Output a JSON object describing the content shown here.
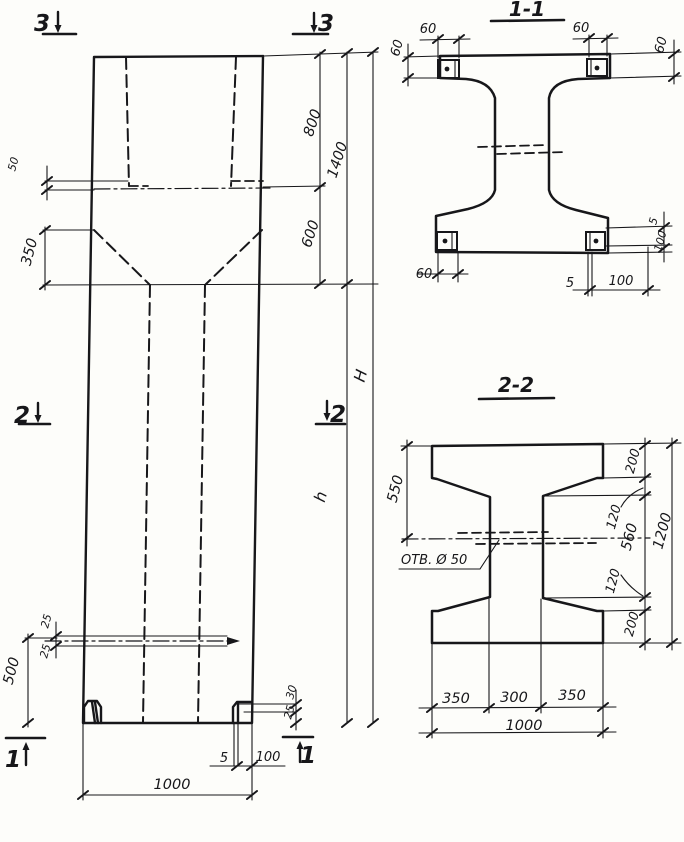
{
  "drawing": {
    "kind": "precast concrete column working drawing",
    "colors": {
      "ink": "#17171a",
      "paper": "#fdfdfa"
    }
  },
  "elevation": {
    "section_markers": {
      "top_left": "3",
      "top_right": "3",
      "mid_left": "2",
      "mid_right": "2",
      "bottom_left": "1",
      "bottom_right": "1"
    },
    "dims": {
      "slot_top_50": "50",
      "taper_350": "350",
      "cap_800": "800",
      "cap_total_1400": "1400",
      "taper_600": "600",
      "total_height": "H",
      "shaft_height": "h",
      "slot_gap_25_a": "25",
      "slot_gap_25_b": "25",
      "base_500": "500",
      "foot_step_30": "30",
      "foot_step_25": "25",
      "foot_gap_5": "5",
      "foot_width_100": "100",
      "width_1000": "1000"
    }
  },
  "section_1_1": {
    "title": "1-1",
    "dims": {
      "top_left_width_60": "60",
      "top_left_height_60": "60",
      "top_right_width_60": "60",
      "top_right_height_60": "60",
      "bottom_left_60": "60",
      "bottom_gap_5": "5",
      "bottom_width_100": "100",
      "right_gap_5": "5",
      "right_height_100": "100"
    }
  },
  "section_2_2": {
    "title": "2-2",
    "hole_label": "ОТВ. Ø 50",
    "dims": {
      "left_550": "550",
      "right_top_200": "200",
      "right_top_120": "120",
      "right_560": "560",
      "right_bottom_120": "120",
      "right_bottom_200": "200",
      "right_total_1200": "1200",
      "bottom_left_350": "350",
      "bottom_300": "300",
      "bottom_right_350": "350",
      "bottom_total_1000": "1000"
    }
  }
}
